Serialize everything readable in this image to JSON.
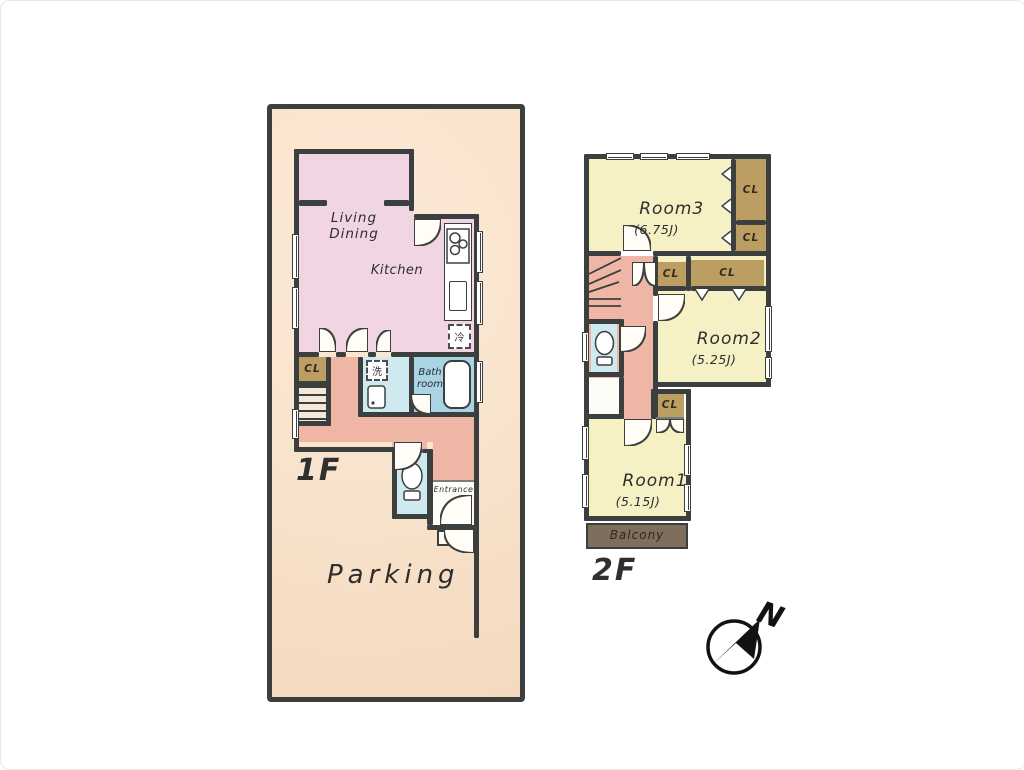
{
  "title": "House floor plan 1F / 2F",
  "colors": {
    "wall": "#3b403e",
    "parcel_fill": "#f8e2cb",
    "living_fill": "#f2d5e3",
    "hall_fill": "#efb6a5",
    "closet_fill": "#bc9d62",
    "bath_fill": "#a9d4e4",
    "wet_area_fill": "#cfe9f0",
    "room_fill_2f": "#f6f1c5",
    "balcony_fill": "#7d6e5e"
  },
  "floor1": {
    "floor_label": "1F",
    "parking_label": "Parking",
    "living_dining_line1": "Living",
    "living_dining_line2": "Dining",
    "kitchen_label": "Kitchen",
    "closet_label": "CL",
    "bath_line1": "Bath",
    "bath_line2": "room",
    "entrance_label": "Entrance",
    "refrigerator_label": "冷",
    "washer_label": "洗"
  },
  "floor2": {
    "floor_label": "2F",
    "closet_label": "CL",
    "room3_name": "Room3",
    "room3_size": "(6.75J)",
    "room2_name": "Room2",
    "room2_size": "(5.25J)",
    "room1_name": "Room1",
    "room1_size": "(5.15J)",
    "balcony_label": "Balcony"
  },
  "compass": {
    "north_label": "N"
  }
}
